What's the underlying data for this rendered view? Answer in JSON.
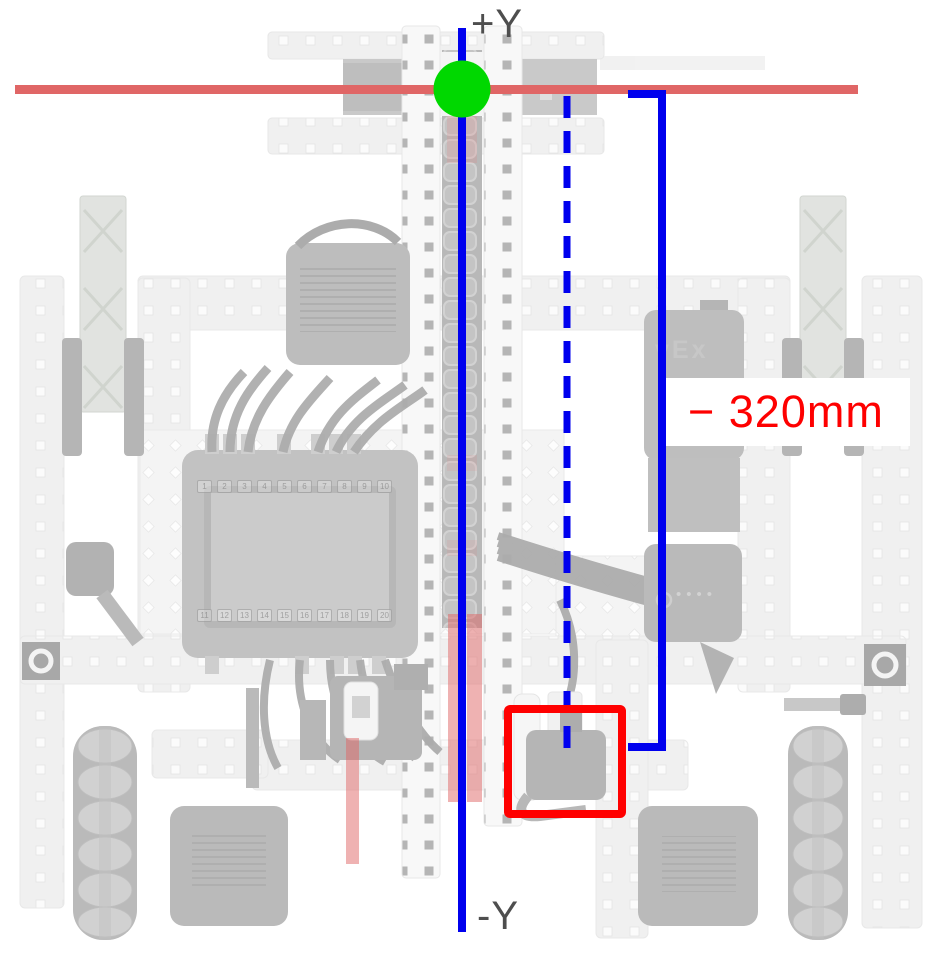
{
  "annotations": {
    "axis_top_label": "+Y",
    "axis_bottom_label": "-Y",
    "distance_label": "− 320mm"
  },
  "robot": {
    "brand_logo": "vEx",
    "radio_dots": "••••",
    "brain_ports_top": [
      "1",
      "2",
      "3",
      "4",
      "5",
      "6",
      "7",
      "8",
      "9",
      "10"
    ],
    "brain_ports_bottom": [
      "11",
      "12",
      "13",
      "14",
      "15",
      "16",
      "17",
      "18",
      "19",
      "20"
    ]
  },
  "colors": {
    "axis_blue": "#0000EE",
    "reference_red": "#E06666",
    "origin_green": "#00D800",
    "highlight_red": "#FF0000",
    "distance_text_red": "#FE0000",
    "axis_text_gray": "#4E4E4E"
  }
}
